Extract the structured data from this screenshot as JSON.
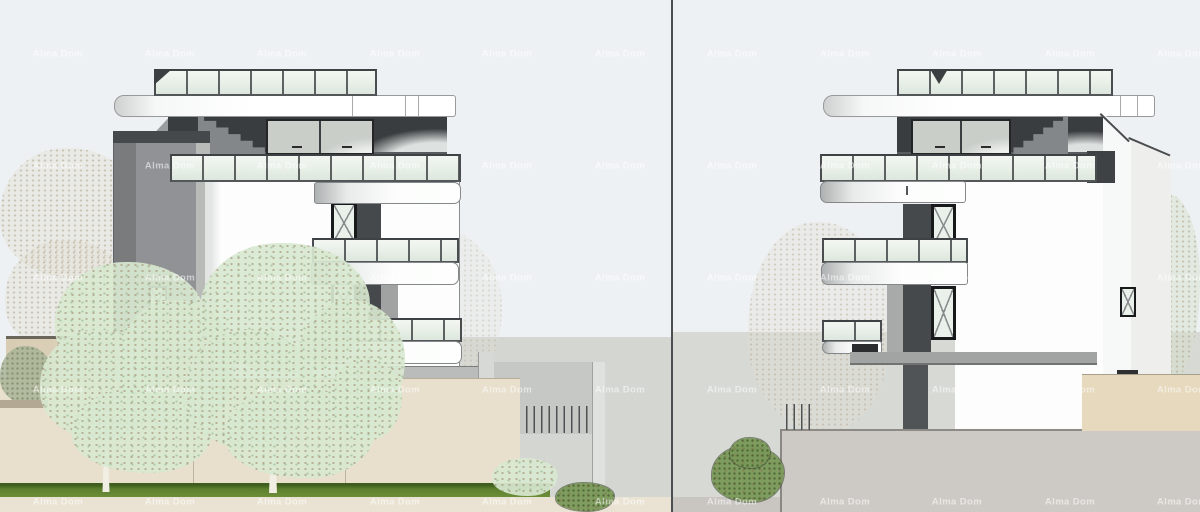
{
  "image_type": "architectural elevation rendering, two building side views separated by a vertical divider",
  "watermark": {
    "text": "Alma Dom",
    "color": "#ffffff",
    "opacity": 0.55,
    "columns_x": [
      58,
      170,
      282,
      395,
      507,
      620,
      732,
      845,
      957,
      1070,
      1182
    ],
    "rows_y": [
      54,
      166,
      278,
      390,
      502
    ]
  },
  "palette": {
    "sky": "#eef1f4",
    "hill": "#d4d6d2",
    "hill2": "#d7d9d5",
    "charcoal": "#3a3d3f",
    "coldark": "#46494b",
    "tower": "#909295",
    "wallwhite": "#fdfdfe",
    "glass": "#e7efe7",
    "beige": "#e8dfcc",
    "beigedark": "#d8cdb4",
    "terrace": "#cdcac5",
    "grass": "#5d7f2e",
    "foliage": "#d8e8d0",
    "bush": "#7a9958"
  },
  "scenes": {
    "left": {
      "label": "left building elevation",
      "building": {
        "roof_glass_railing": true,
        "balconies": 3,
        "x_marked_windows": 3,
        "stair_tower": true,
        "interior_staircase_visible": true
      },
      "landscape": {
        "foreground_trees": 2,
        "retaining_walls": "beige",
        "grass_strip": true,
        "garage_structure": true
      }
    },
    "right": {
      "label": "right building elevation (mirrored)",
      "building": {
        "roof_glass_railing": true,
        "balconies": 3,
        "x_marked_windows": 3,
        "interior_staircase_visible": true
      },
      "landscape": {
        "terrace_wall": "gray",
        "beige_wall": true,
        "foreground_bush": true,
        "background_trees": 2
      }
    }
  }
}
